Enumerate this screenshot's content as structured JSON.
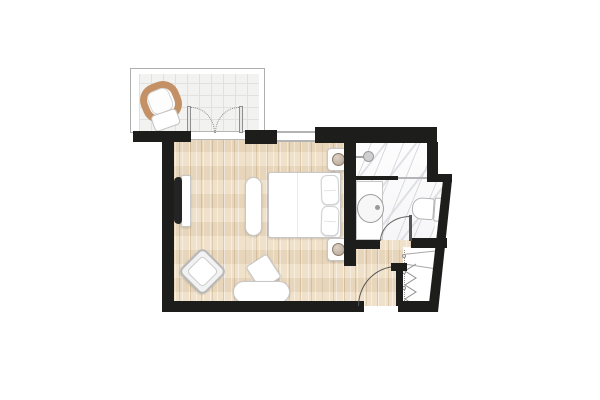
{
  "diagram": {
    "type": "hotel-room-floor-plan",
    "orientation": "top-down",
    "rooms": [
      {
        "name": "balcony",
        "floor": "tile-grid",
        "features": [
          "wicker-lounge-chair",
          "french-double-door-to-bedroom"
        ]
      },
      {
        "name": "bedroom-living",
        "floor": "wood-plank",
        "features": [
          "double-bed",
          "two-nightstands-with-lamps",
          "bench-at-bed-foot",
          "wall-mounted-tv-with-console",
          "rotated-armchair",
          "desk-with-chair",
          "window-on-top-wall"
        ]
      },
      {
        "name": "bathroom",
        "floor": "marble",
        "features": [
          "walk-in-shower-with-partition",
          "shower-head",
          "vanity-with-round-sink",
          "toilet",
          "inward-swinging-door",
          "glass-panel"
        ]
      },
      {
        "name": "entry-hall",
        "floor": "wood-plank",
        "features": [
          "entry-door-swinging-in"
        ]
      },
      {
        "name": "closet",
        "floor": "none",
        "features": [
          "accordion-door",
          "shelf-lines",
          "dotted-opening-line"
        ]
      }
    ],
    "doors": [
      {
        "name": "french-balcony-doors",
        "swing": "double-outward-dotted"
      },
      {
        "name": "bathroom-door",
        "swing": "quarter-arc-into-bathroom"
      },
      {
        "name": "entry-door",
        "swing": "quarter-arc-into-entry"
      }
    ]
  },
  "colors": {
    "wall": "#1d1d1b",
    "wood_base": "#eddcc2",
    "wood_grain": "rgba(180,146,99,0.35)",
    "balcony_tile": "#f2f2f0",
    "tile_line": "#e1e1df",
    "marble_vein": "#d9dade",
    "furniture_fill": "#ffffff",
    "furniture_line": "#c7c7c7",
    "wicker": "#c49066",
    "lamp": "#b4a291"
  }
}
